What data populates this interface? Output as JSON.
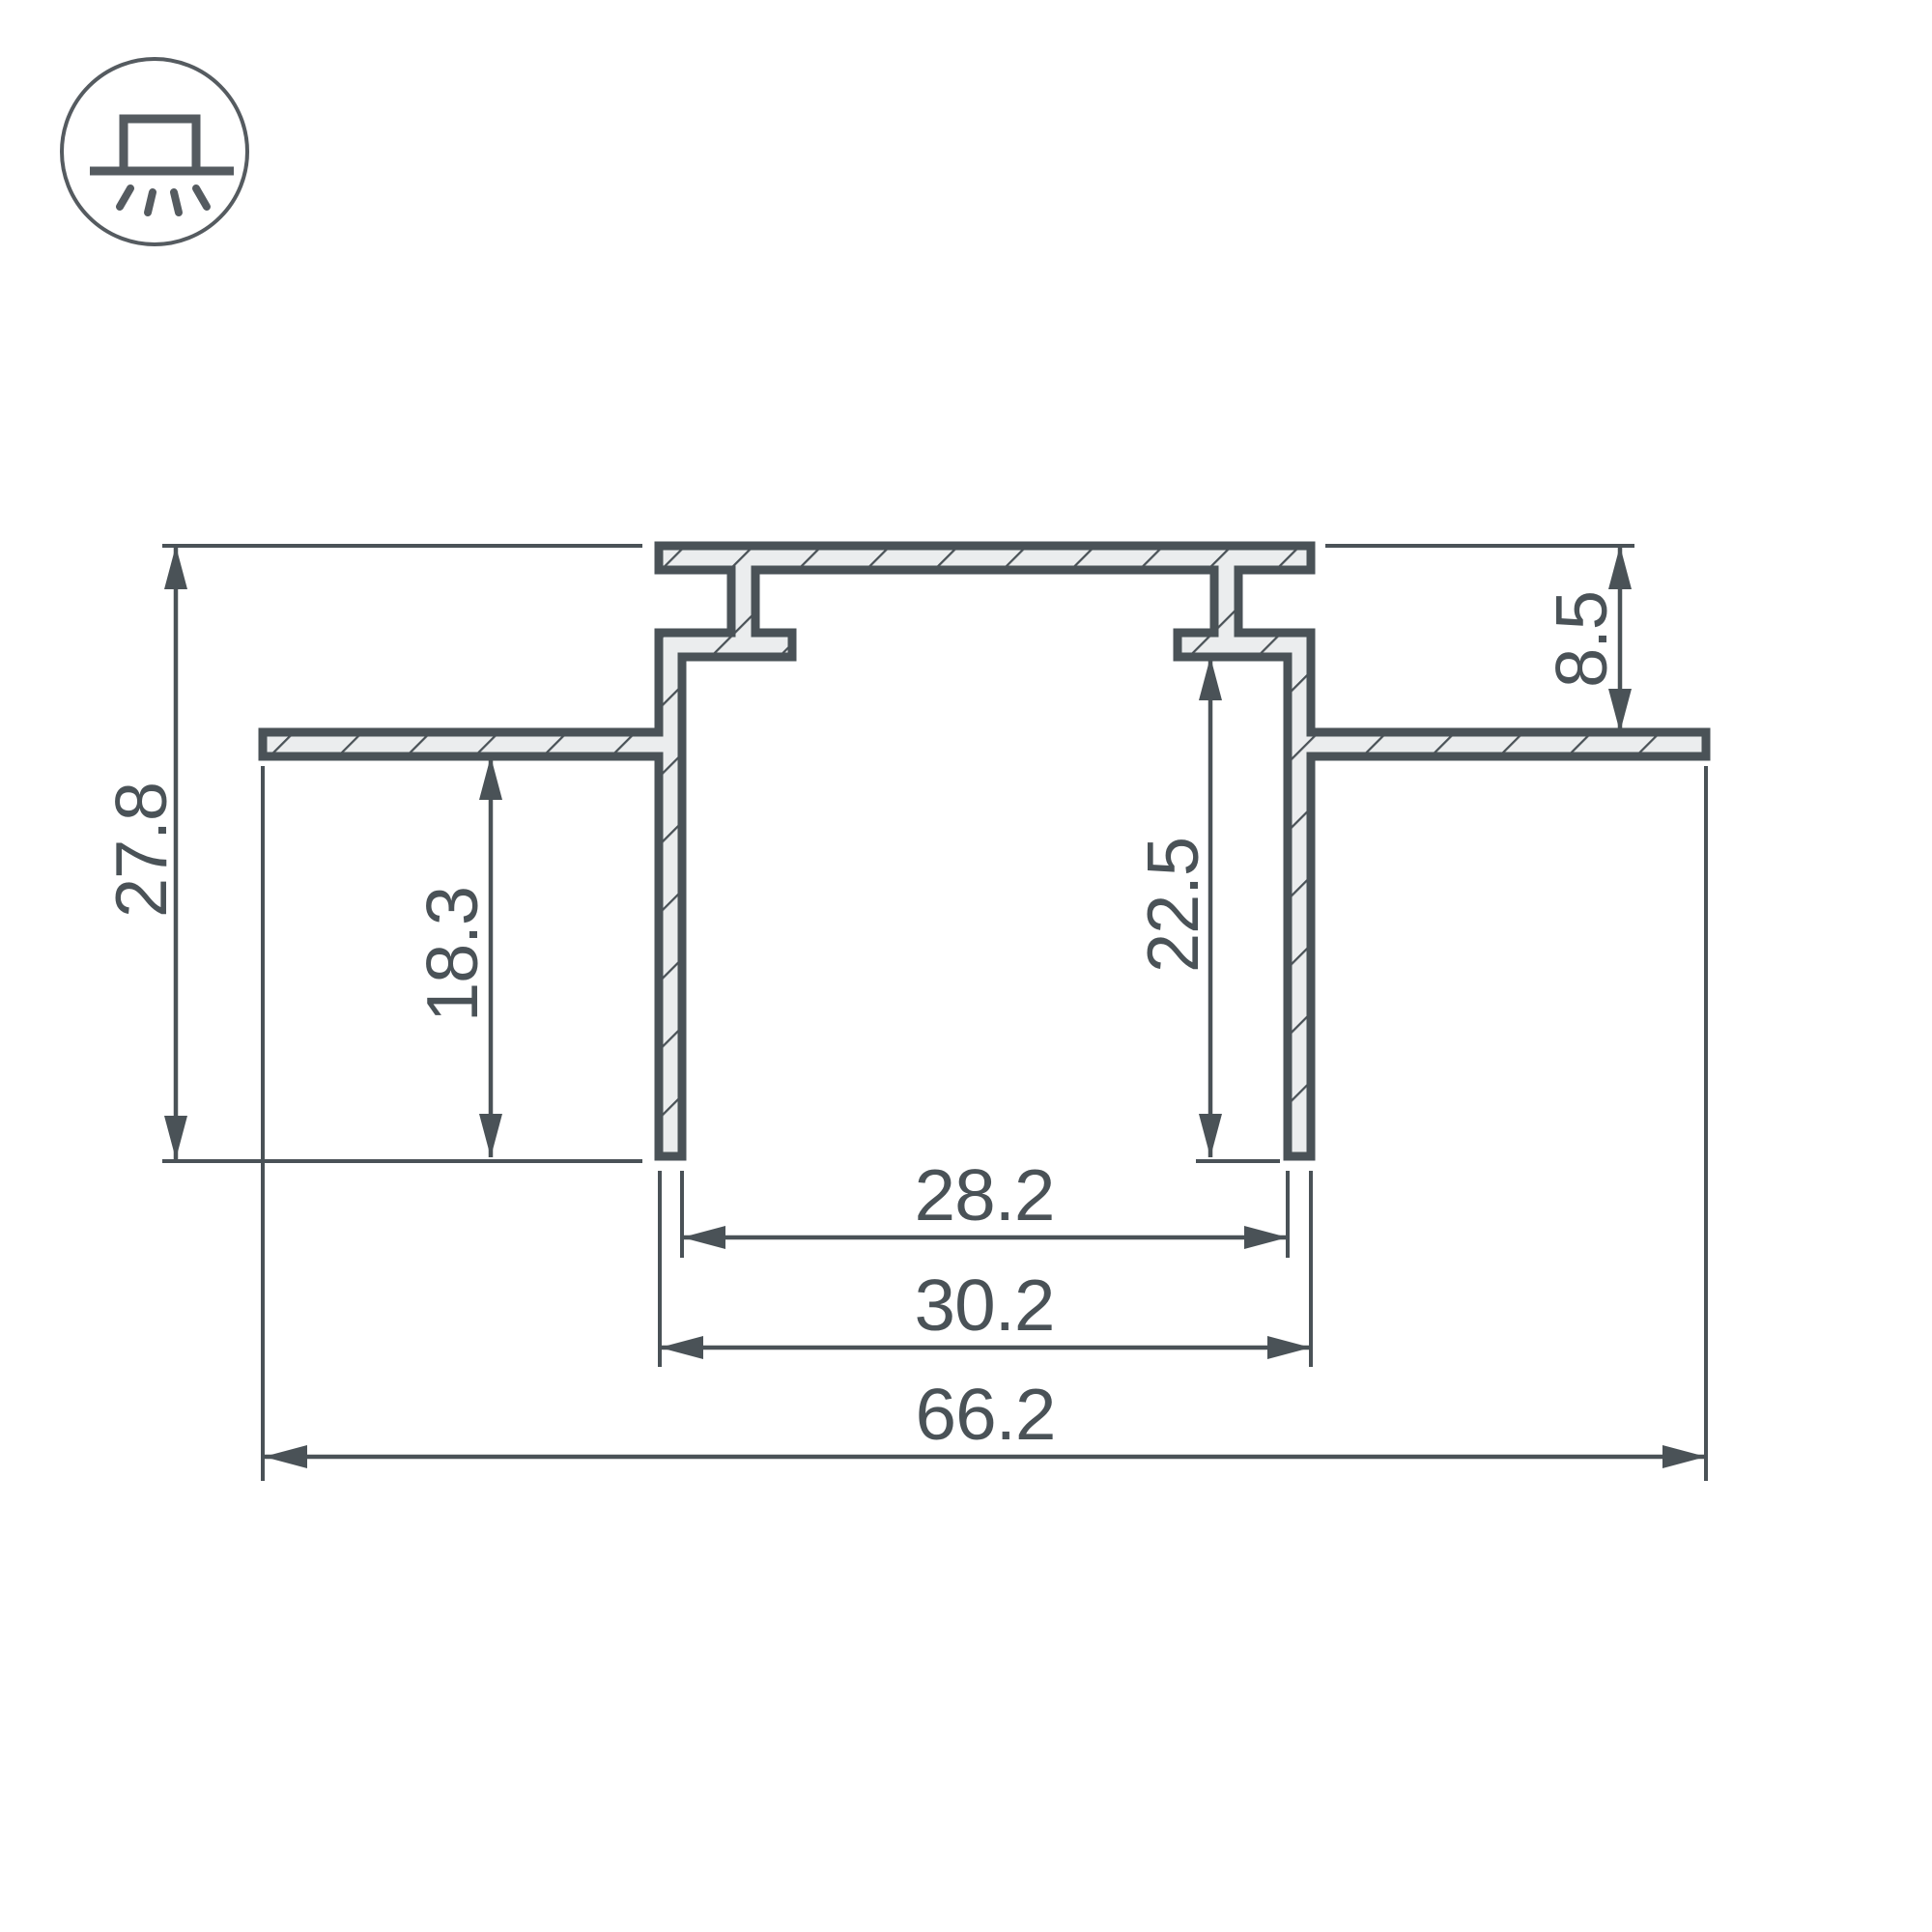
{
  "drawing": {
    "type": "profile-cross-section-technical-drawing",
    "colors": {
      "line": "#4a5257",
      "section_fill": "#ebedee",
      "background": "#ffffff"
    },
    "icon": {
      "name": "recessed-ceiling-light",
      "description": "circle badge with surface-mounted luminaire emitting light downward"
    },
    "labels": {
      "overall_height": "27.8",
      "flange_depth": "18.3",
      "recess_height": "8.5",
      "inner_depth": "22.5",
      "inner_width": "28.2",
      "outer_width": "30.2",
      "overall_width": "66.2"
    }
  }
}
